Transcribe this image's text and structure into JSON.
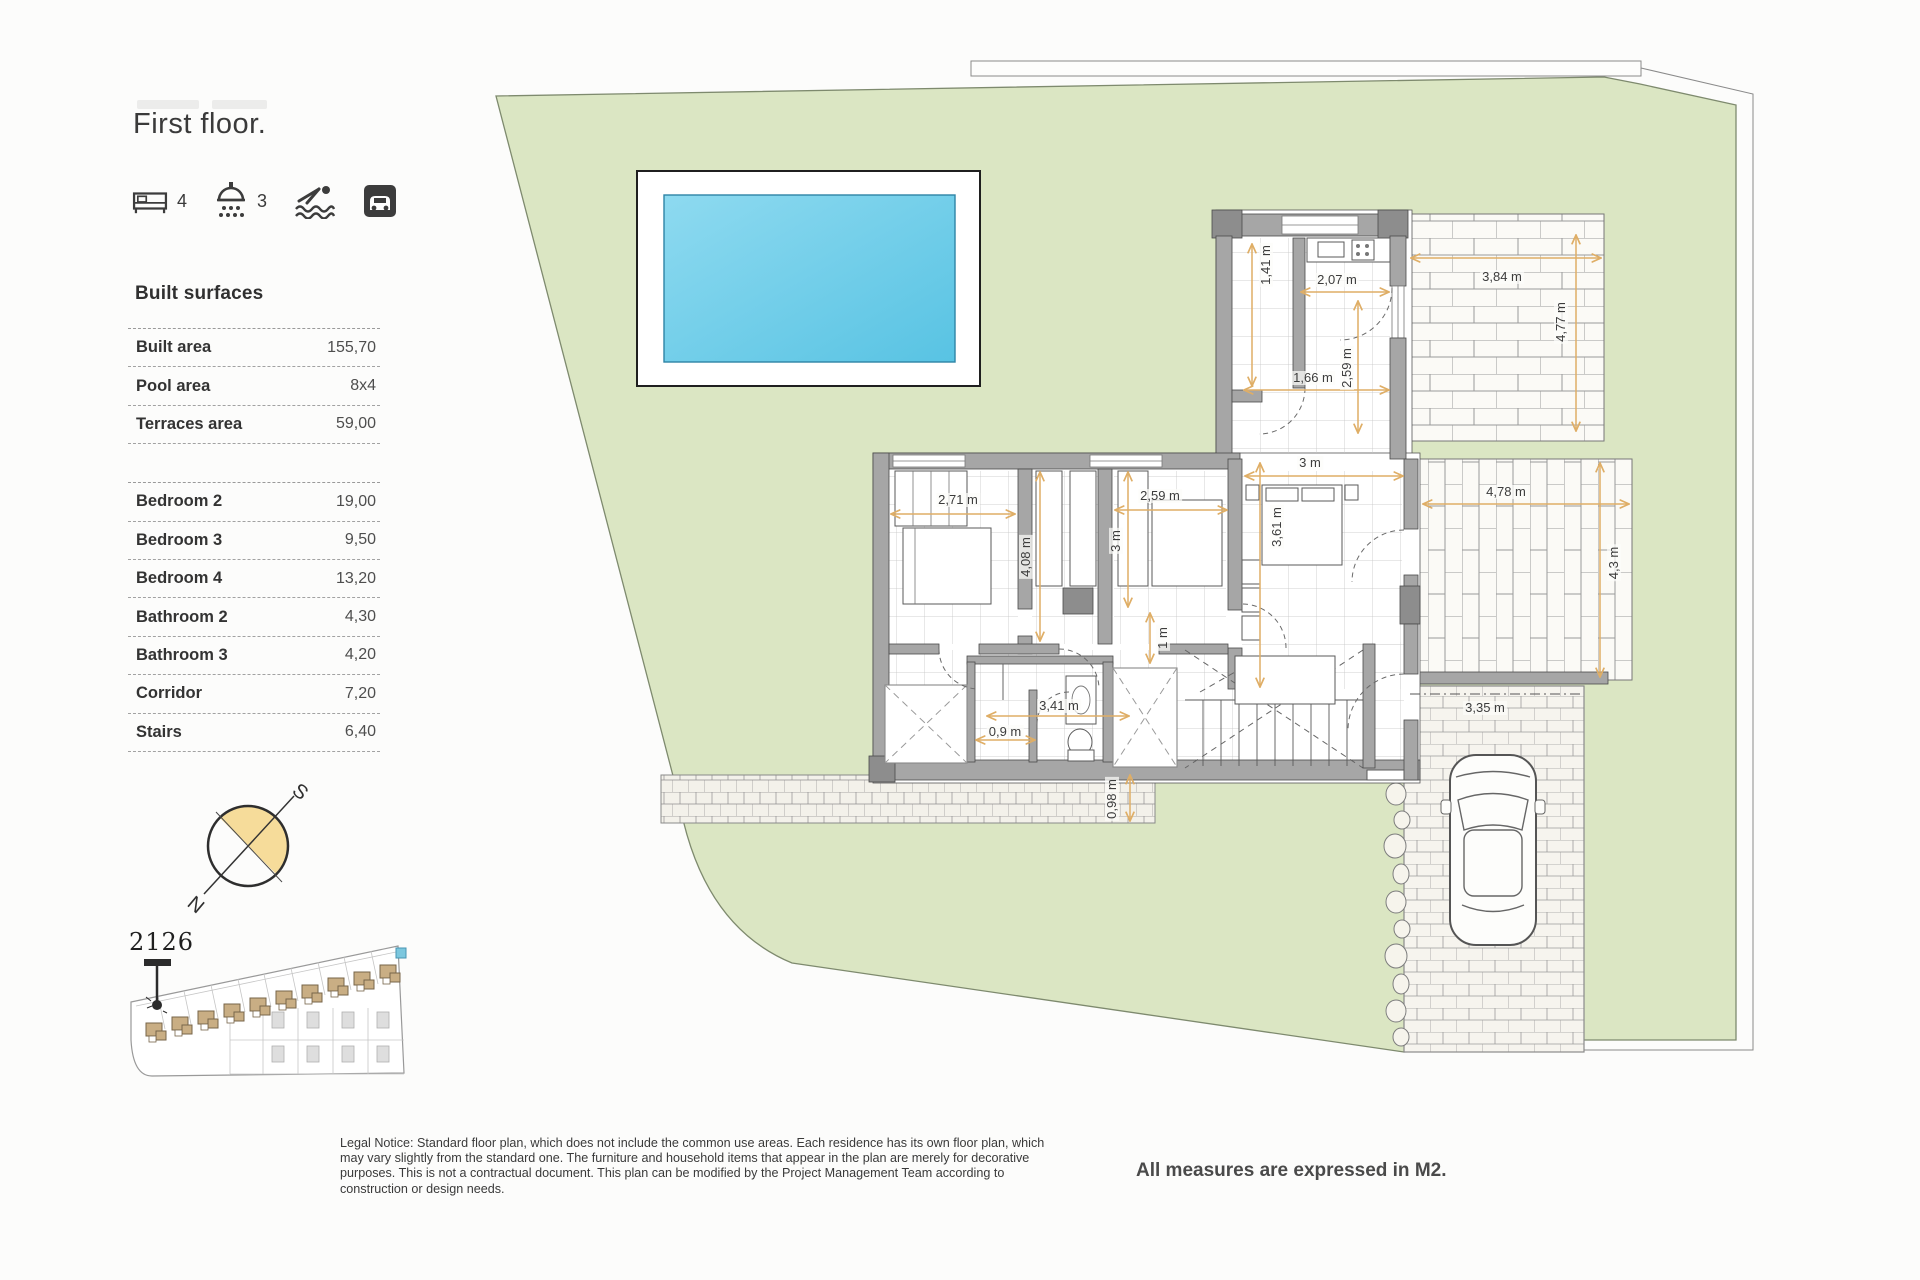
{
  "header": {
    "title": "First floor.",
    "features": [
      {
        "icon": "bed-icon",
        "count": "4"
      },
      {
        "icon": "shower-icon",
        "count": "3"
      },
      {
        "icon": "swimmer-icon",
        "count": ""
      },
      {
        "icon": "garage-icon",
        "count": ""
      }
    ]
  },
  "surfaces": {
    "heading": "Built surfaces",
    "rows": [
      {
        "label": "Built area",
        "value": "155,70"
      },
      {
        "label": "Pool area",
        "value": "8x4"
      },
      {
        "label": "Terraces area",
        "value": "59,00"
      },
      {
        "label": "Bedroom 2",
        "value": "19,00"
      },
      {
        "label": "Bedroom 3",
        "value": "9,50"
      },
      {
        "label": "Bedroom 4",
        "value": "13,20"
      },
      {
        "label": "Bathroom 2",
        "value": "4,30"
      },
      {
        "label": "Bathroom 3",
        "value": "4,20"
      },
      {
        "label": "Corridor",
        "value": "7,20"
      },
      {
        "label": "Stairs",
        "value": "6,40"
      }
    ]
  },
  "compass": {
    "south": "S",
    "north": "N"
  },
  "site_map": {
    "unit": "2126"
  },
  "plan": {
    "dimensions": [
      {
        "text": "1,41 m"
      },
      {
        "text": "2,07 m"
      },
      {
        "text": "3,84 m"
      },
      {
        "text": "4,77 m"
      },
      {
        "text": "1,66 m"
      },
      {
        "text": "2,59 m"
      },
      {
        "text": "3 m"
      },
      {
        "text": "2,71 m"
      },
      {
        "text": "2,59 m"
      },
      {
        "text": "3,61 m"
      },
      {
        "text": "4,78 m"
      },
      {
        "text": "4,3 m"
      },
      {
        "text": "4,08 m"
      },
      {
        "text": "3 m"
      },
      {
        "text": "1 m"
      },
      {
        "text": "3,41 m"
      },
      {
        "text": "0,9 m"
      },
      {
        "text": "0,98 m"
      },
      {
        "text": "3,35 m"
      }
    ]
  },
  "footer": {
    "legal": "Legal Notice: Standard floor plan, which does not include the common use areas. Each residence has its own floor plan, which may vary slightly from the standard one. The furniture and household items that appear in the plan are merely for decorative purposes. This is not a contractual document. This plan can be modified by the Project Management Team according to construction or design needs.",
    "units_note": "All measures are expressed in M2."
  },
  "colors": {
    "lawn": "#dbe6c3",
    "pool_water": "#68cbe7",
    "wall_gray": "#a6a6a6",
    "dimension_accent": "#dfae66",
    "compass_fill": "#f6dc9a"
  }
}
